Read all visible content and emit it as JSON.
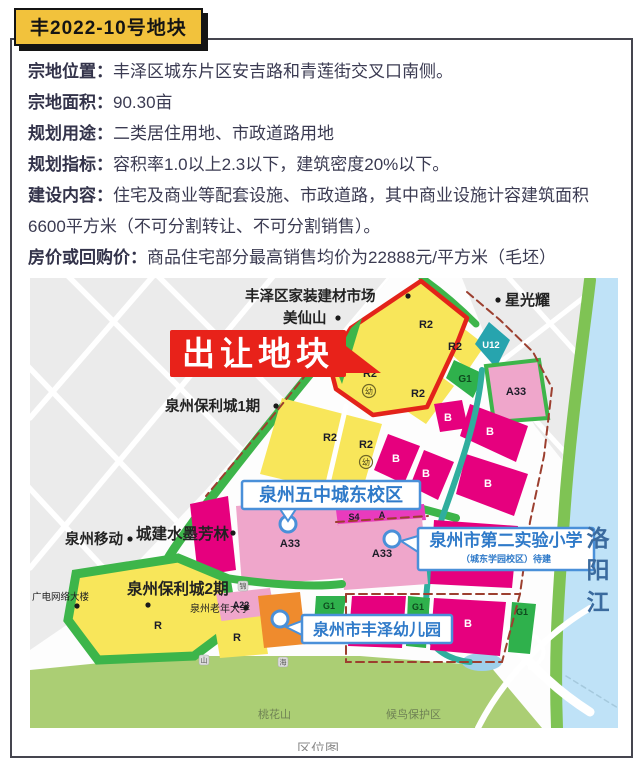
{
  "page": {
    "badge": "丰2022-10号地块",
    "caption": "区位图"
  },
  "info_rows": [
    {
      "label": "宗地位置：",
      "value": "丰泽区城东片区安吉路和青莲街交叉口南侧。"
    },
    {
      "label": "宗地面积：",
      "value": "90.30亩"
    },
    {
      "label": "规划用途：",
      "value": "二类居住用地、市政道路用地"
    },
    {
      "label": "规划指标：",
      "value": "容积率1.0以上2.3以下，建筑密度20%以下。"
    },
    {
      "label": "建设内容：",
      "value": "住宅及商业等配套设施、市政道路，其中商业设施计容建筑面积6600平方米（不可分割转让、不可分割销售）。"
    },
    {
      "label": "房价或回购价：",
      "value": "商品住宅部分最高销售均价为22888元/平方米（毛坯）"
    }
  ],
  "colors": {
    "badge_yellow": "#f2c23c",
    "accent_red": "#e8221a",
    "outline_red": "#e3231a",
    "parcel_yellow": "#f8e65a",
    "parcel_green": "#3db54a",
    "parcel_magenta": "#e6007e",
    "parcel_pink": "#efa6cb",
    "parcel_teal": "#27a4ae",
    "parcel_orange": "#ef8b2d",
    "water_blue": "#bfe2f7",
    "banner_blue": "#4a90d9",
    "boundary_dash": "#9c3f2f"
  },
  "map": {
    "sale_callout": {
      "text": "出让地块",
      "x": 140,
      "y": 52,
      "w": 176,
      "h": 47,
      "arrow": "316,68 351,95 316,95",
      "fill": "#e8221a"
    },
    "river": {
      "chars": [
        "洛",
        "阳",
        "江"
      ],
      "x": 568,
      "y0": 268,
      "dy": 32,
      "fill": "#3a6a9e",
      "fs": 23
    },
    "shapes": [
      {
        "n": "map-background",
        "t": "rect",
        "x": 0,
        "y": 0,
        "wd": 588,
        "ht": 450,
        "f": "#fdfdfd"
      },
      {
        "n": "city-blocks-topleft",
        "t": "polygon",
        "pts": "0,0 360,0 316,52 246,132 174,214 98,294 38,346 0,372",
        "f": "#ebebeb"
      },
      {
        "n": "road",
        "t": "path",
        "d": "M0,140 L130,-10",
        "s": "#ffffff",
        "sw": 5.5,
        "clip": "url(#clipTL)"
      },
      {
        "n": "road",
        "t": "path",
        "d": "M0,290 L250,-10",
        "s": "#ffffff",
        "sw": 5.5,
        "clip": "url(#clipTL)"
      },
      {
        "n": "road",
        "t": "path",
        "d": "M40,380 L360,0",
        "s": "#ffffff",
        "sw": 5.5,
        "clip": "url(#clipTL)"
      },
      {
        "n": "road",
        "t": "path",
        "d": "M150,390 L380,120",
        "s": "#ffffff",
        "sw": 5.5,
        "clip": "url(#clipTL)"
      },
      {
        "n": "road",
        "t": "path",
        "d": "M30,-10 L330,290",
        "s": "#ffffff",
        "sw": 5.5,
        "clip": "url(#clipTL)"
      },
      {
        "n": "road",
        "t": "path",
        "d": "M-10,80 L230,330",
        "s": "#ffffff",
        "sw": 5.5,
        "clip": "url(#clipTL)"
      },
      {
        "n": "road",
        "t": "path",
        "d": "M-10,200 L120,340",
        "s": "#ffffff",
        "sw": 5.5,
        "clip": "url(#clipTL)"
      },
      {
        "n": "road",
        "t": "path",
        "d": "M120,-10 L300,170",
        "s": "#ffffff",
        "sw": 5.5,
        "clip": "url(#clipTL)"
      },
      {
        "n": "city-blocks-topright",
        "t": "polygon",
        "pts": "432,0 566,0 552,98 532,182 505,148 456,60",
        "f": "#ebebeb"
      },
      {
        "n": "road",
        "t": "path",
        "d": "M470,-10 L560,90",
        "s": "#ffffff",
        "sw": 5,
        "clip": "url(#clipTR)"
      },
      {
        "n": "road",
        "t": "path",
        "d": "M430,60 L540,180",
        "s": "#ffffff",
        "sw": 5,
        "clip": "url(#clipTR)"
      },
      {
        "n": "road",
        "t": "path",
        "d": "M450,100 L566,10",
        "s": "#ffffff",
        "sw": 5,
        "clip": "url(#clipTR)"
      },
      {
        "n": "river-water",
        "t": "polygon",
        "pts": "566,0 588,0 588,450 526,450 521,392 526,310 533,236 543,150 556,70",
        "f": "#bfe2f7"
      },
      {
        "n": "shore-green",
        "t": "path",
        "d": "M560,2 C552,70 540,150 534,240 C529,310 524,370 527,450",
        "s": "#7fc354",
        "sw": 12
      },
      {
        "n": "water-boundary-dash",
        "t": "path",
        "d": "M536,398 L588,430",
        "s": "#a5c9dd",
        "sw": 1.5,
        "dash": "5 4"
      },
      {
        "n": "hill-green",
        "t": "polygon",
        "pts": "0,392 140,378 330,378 460,388 512,450 0,450",
        "f": "#abce74"
      },
      {
        "n": "highway",
        "t": "path",
        "d": "M428,268 C452,330 494,392 560,434",
        "s": "#ffffff",
        "sw": 9
      },
      {
        "n": "highway-ramp",
        "t": "path",
        "d": "M560,330 C516,356 472,402 448,450",
        "s": "#ffffff",
        "sw": 6
      },
      {
        "n": "highway-loop",
        "t": "path",
        "d": "M478,362 q20,-16 32,2 q10,16 -10,26",
        "s": "#ffffff",
        "sw": 4
      },
      {
        "n": "pond",
        "t": "ellipse",
        "cx": 452,
        "cy": 384,
        "rx": 20,
        "ry": 9,
        "f": "#9fd0ea"
      },
      {
        "n": "green-strip-west",
        "t": "path",
        "d": "M306,64 C262,118 214,176 166,240 C150,262 138,278 132,292",
        "s": "#3db54a",
        "sw": 9
      },
      {
        "n": "green-strip-north",
        "t": "path",
        "d": "M392,0 C412,14 430,30 446,46",
        "s": "#3db54a",
        "sw": 7
      },
      {
        "n": "parcel-r2-ne",
        "t": "polygon",
        "pts": "428,46 455,67 438,92 408,63",
        "f": "#f8e65a"
      },
      {
        "n": "parcel-u12",
        "t": "polygon",
        "pts": "459,44 480,62 466,90 445,66",
        "f": "#27a4ae"
      },
      {
        "n": "parcel-g1-park",
        "t": "polygon",
        "pts": "424,82 454,96 443,120 416,100",
        "f": "#2fb14c"
      },
      {
        "n": "parcel-a33-ne",
        "t": "polygon",
        "pts": "456,88 509,82 518,140 464,144",
        "f": "#efa6cb",
        "s": "#3db54a",
        "sw": 4
      },
      {
        "n": "parcel-r2-mid",
        "t": "polygon",
        "pts": "394,86 424,108 396,146 360,122",
        "f": "#f8e65a"
      },
      {
        "n": "parcel-b",
        "t": "polygon",
        "pts": "404,126 432,122 438,150 410,154",
        "f": "#e6007e"
      },
      {
        "n": "parcel-b",
        "t": "polygon",
        "pts": "440,126 498,148 486,184 430,158",
        "f": "#e6007e"
      },
      {
        "n": "parcel-r2-southwest",
        "t": "polygon",
        "pts": "252,120 352,146 330,220 230,196",
        "f": "#f8e65a"
      },
      {
        "n": "road",
        "t": "path",
        "d": "M316,128 L296,214",
        "s": "#ffffff",
        "sw": 5
      },
      {
        "n": "parcel-b",
        "t": "polygon",
        "pts": "358,156 390,168 374,206 344,192",
        "f": "#e6007e"
      },
      {
        "n": "parcel-b",
        "t": "polygon",
        "pts": "394,172 424,184 408,222 380,208",
        "f": "#e6007e"
      },
      {
        "n": "parcel-b",
        "t": "polygon",
        "pts": "436,176 498,196 484,238 426,216",
        "f": "#e6007e"
      },
      {
        "n": "green-strip-mid",
        "t": "path",
        "d": "M330,214 L426,240",
        "s": "#3db54a",
        "sw": 8
      },
      {
        "n": "canal",
        "t": "path",
        "d": "M452,92 C448,140 430,190 412,240 C400,280 392,320 398,355 C402,372 420,382 440,384",
        "s": "#2fae9e",
        "sw": 6
      },
      {
        "n": "parcel-shuimo",
        "t": "polygon",
        "pts": "160,226 198,218 206,292 168,298",
        "f": "#e6007e"
      },
      {
        "n": "parcel-a33-school1",
        "t": "polygon",
        "pts": "206,228 306,220 314,300 212,308",
        "f": "#efa6cb"
      },
      {
        "n": "green-edge",
        "t": "path",
        "d": "M309,222 L317,300",
        "s": "#3db54a",
        "sw": 6
      },
      {
        "n": "parcel-s4a-strip",
        "t": "polygon",
        "pts": "306,232 394,226 396,242 308,248",
        "f": "#e93bbd"
      },
      {
        "n": "parcel-a33-school2",
        "t": "polygon",
        "pts": "308,246 392,240 398,306 314,312",
        "f": "#efa6cb"
      },
      {
        "n": "parcel-b",
        "t": "polygon",
        "pts": "404,242 488,248 482,310 400,306",
        "f": "#e6007e"
      },
      {
        "n": "green-strip-south",
        "t": "path",
        "d": "M150,292 C220,306 280,310 312,306",
        "s": "#3db54a",
        "sw": 8
      },
      {
        "n": "parcel-r-poly2",
        "t": "polygon",
        "pts": "46,296 148,280 196,300 204,348 164,378 68,382 38,342",
        "f": "#f8e65a",
        "s": "#3db54a",
        "sw": 9
      },
      {
        "n": "parcel-a22",
        "t": "polygon",
        "pts": "186,316 240,310 246,340 192,346",
        "f": "#efa6cb"
      },
      {
        "n": "parcel-r-small",
        "t": "polygon",
        "pts": "184,344 232,338 238,376 190,380",
        "f": "#f8e65a"
      },
      {
        "n": "parcel-g1-west",
        "t": "polygon",
        "pts": "286,318 316,318 312,348 284,346",
        "f": "#2fb14c"
      },
      {
        "n": "parcel-kindergarten-orange",
        "t": "polygon",
        "pts": "228,318 270,314 276,366 234,370",
        "f": "#ef8b2d"
      },
      {
        "n": "parcel-b",
        "t": "polygon",
        "pts": "322,318 376,318 372,370 318,368",
        "f": "#e6007e"
      },
      {
        "n": "parcel-g1-strip",
        "t": "polygon",
        "pts": "378,318 400,320 396,370 376,368",
        "f": "#2fb14c"
      },
      {
        "n": "parcel-b",
        "t": "polygon",
        "pts": "404,320 476,324 470,378 400,372",
        "f": "#e6007e"
      },
      {
        "n": "parcel-g1-east",
        "t": "polygon",
        "pts": "482,324 506,326 500,376 478,374",
        "f": "#2fb14c"
      },
      {
        "n": "sale-parcel-red-outline",
        "t": "polygon",
        "pts": "391,3 437,40 428,63 397,129 343,137 306,111 299,84 321,50",
        "f": "#f8e65a",
        "s": "#e3231a",
        "sw": 4.5,
        "join": "round"
      },
      {
        "n": "green-sliver",
        "t": "polygon",
        "pts": "321,50 332,40 312,106 303,84",
        "f": "#3db54a"
      },
      {
        "n": "boundary-dash",
        "t": "path",
        "d": "M437,14 L470,42 L503,74 L522,110 L514,178 L500,244 L490,316 L472,384",
        "s": "#9c3f2f",
        "sw": 2,
        "dash": "8 5"
      },
      {
        "n": "boundary-dash",
        "t": "path",
        "d": "M316,316 L490,316",
        "s": "#9c3f2f",
        "sw": 2,
        "dash": "8 5"
      },
      {
        "n": "boundary-dash",
        "t": "path",
        "d": "M316,316 L316,384 L472,384",
        "s": "#9c3f2f",
        "sw": 2,
        "dash": "8 5"
      },
      {
        "n": "boundary-dash",
        "t": "path",
        "d": "M306,244 L398,238",
        "s": "#9c3f2f",
        "sw": 2,
        "dash": "8 5"
      },
      {
        "n": "boundary-dash",
        "t": "path",
        "d": "M302,64 L238,144 L176,218",
        "s": "#9c3f2f",
        "sw": 2,
        "dash": "8 5"
      }
    ],
    "parcel_labels": [
      {
        "txt": "R2",
        "x": 396,
        "y": 50,
        "fs": 11,
        "fill": "#1c1c28",
        "w": "bold"
      },
      {
        "txt": "R2",
        "x": 340,
        "y": 99,
        "fs": 11,
        "fill": "#1c1c28",
        "w": "bold"
      },
      {
        "txt": "R2",
        "x": 425,
        "y": 72,
        "fs": 11,
        "fill": "#1c1c28",
        "w": "bold"
      },
      {
        "txt": "U12",
        "x": 461,
        "y": 70,
        "fs": 9.5,
        "fill": "#ffffff",
        "w": "bold"
      },
      {
        "txt": "G1",
        "x": 435,
        "y": 104,
        "fs": 10,
        "fill": "#0e4a1e",
        "w": "bold"
      },
      {
        "txt": "A33",
        "x": 486,
        "y": 117,
        "fs": 11,
        "fill": "#1c1c28",
        "w": "bold"
      },
      {
        "txt": "R2",
        "x": 388,
        "y": 119,
        "fs": 11,
        "fill": "#1c1c28",
        "w": "bold"
      },
      {
        "txt": "B",
        "x": 418,
        "y": 143,
        "fs": 11,
        "fill": "#ffffff",
        "w": "bold"
      },
      {
        "txt": "B",
        "x": 460,
        "y": 157,
        "fs": 11,
        "fill": "#ffffff",
        "w": "bold"
      },
      {
        "txt": "R2",
        "x": 300,
        "y": 163,
        "fs": 11,
        "fill": "#1c1c28",
        "w": "bold"
      },
      {
        "txt": "R2",
        "x": 336,
        "y": 170,
        "fs": 11,
        "fill": "#1c1c28",
        "w": "bold"
      },
      {
        "txt": "B",
        "x": 366,
        "y": 184,
        "fs": 11,
        "fill": "#ffffff",
        "w": "bold"
      },
      {
        "txt": "B",
        "x": 396,
        "y": 199,
        "fs": 11,
        "fill": "#ffffff",
        "w": "bold"
      },
      {
        "txt": "B",
        "x": 458,
        "y": 209,
        "fs": 11,
        "fill": "#ffffff",
        "w": "bold"
      },
      {
        "txt": "S4",
        "x": 324,
        "y": 242,
        "fs": 9,
        "fill": "#1c1c28",
        "w": "bold"
      },
      {
        "txt": "A",
        "x": 352,
        "y": 240,
        "fs": 9,
        "fill": "#1c1c28",
        "w": "bold"
      },
      {
        "txt": "A33",
        "x": 260,
        "y": 269,
        "fs": 11,
        "fill": "#1c1c28",
        "w": "bold"
      },
      {
        "txt": "A33",
        "x": 352,
        "y": 279,
        "fs": 11,
        "fill": "#1c1c28",
        "w": "bold"
      },
      {
        "txt": "A22",
        "x": 211,
        "y": 330,
        "fs": 9,
        "fill": "#1c1c28",
        "w": "bold"
      },
      {
        "txt": "R",
        "x": 128,
        "y": 351,
        "fs": 11,
        "fill": "#1c1c28",
        "w": "bold"
      },
      {
        "txt": "R",
        "x": 207,
        "y": 363,
        "fs": 11,
        "fill": "#1c1c28",
        "w": "bold"
      },
      {
        "txt": "G1",
        "x": 299,
        "y": 331,
        "fs": 9,
        "fill": "#0e4a1e",
        "w": "bold"
      },
      {
        "txt": "S4",
        "x": 297,
        "y": 343,
        "fs": 8.5,
        "fill": "#0e4a1e",
        "w": "bold"
      },
      {
        "txt": "G1",
        "x": 388,
        "y": 332,
        "fs": 9,
        "fill": "#0e4a1e",
        "w": "bold"
      },
      {
        "txt": "B",
        "x": 438,
        "y": 349,
        "fs": 11,
        "fill": "#ffffff",
        "w": "bold"
      },
      {
        "txt": "G1",
        "x": 492,
        "y": 337,
        "fs": 9,
        "fill": "#0e4a1e",
        "w": "bold"
      }
    ],
    "poi_labels": [
      {
        "txt": "丰泽区家装建材市场",
        "x": 215,
        "y": 23,
        "fs": 14.5,
        "w": "600"
      },
      {
        "txt": "美仙山",
        "x": 253,
        "y": 45,
        "fs": 14.5,
        "w": "600"
      },
      {
        "txt": "星光耀",
        "x": 475,
        "y": 27,
        "fs": 15,
        "w": "600"
      },
      {
        "txt": "泉州保利城1期",
        "x": 135,
        "y": 133,
        "fs": 14.5,
        "w": "600"
      },
      {
        "txt": "泉州移动",
        "x": 35,
        "y": 266,
        "fs": 14.5,
        "w": "600"
      },
      {
        "txt": "城建水墨芳林",
        "x": 106,
        "y": 261,
        "fs": 15.5,
        "w": "bold"
      },
      {
        "txt": "广电网络大楼",
        "x": 2,
        "y": 322,
        "fs": 9.5,
        "w": "normal"
      },
      {
        "txt": "泉州保利城2期",
        "x": 97,
        "y": 316,
        "fs": 15.5,
        "w": "bold"
      },
      {
        "txt": "泉州老年大学",
        "x": 160,
        "y": 334,
        "fs": 10,
        "w": "normal"
      },
      {
        "txt": "桃花山",
        "x": 228,
        "y": 440,
        "fs": 11,
        "w": "normal",
        "fill": "#6f8254"
      },
      {
        "txt": "候鸟保护区",
        "x": 356,
        "y": 440,
        "fs": 11,
        "w": "normal",
        "fill": "#6f8254"
      }
    ],
    "dots": [
      {
        "x": 378,
        "y": 18
      },
      {
        "x": 308,
        "y": 40
      },
      {
        "x": 468,
        "y": 22
      },
      {
        "x": 246,
        "y": 128
      },
      {
        "x": 100,
        "y": 261
      },
      {
        "x": 203,
        "y": 255
      },
      {
        "x": 47,
        "y": 328
      },
      {
        "x": 118,
        "y": 327
      },
      {
        "x": 216,
        "y": 330
      }
    ],
    "road_badges": [
      {
        "c": "锦",
        "x": 213,
        "y": 308
      },
      {
        "c": "海",
        "x": 240,
        "y": 218
      },
      {
        "c": "山",
        "x": 174,
        "y": 382
      },
      {
        "c": "海",
        "x": 253,
        "y": 384
      }
    ],
    "banners": [
      {
        "text": "泉州五中城东校区",
        "x": 212,
        "y": 203,
        "w": 178,
        "h": 28,
        "fs": 18,
        "tail": "250,231 266,231 258,243",
        "cx": 258,
        "cy": 246
      },
      {
        "text": "泉州市第二实验小学",
        "sub": "（城东学园校区）待建",
        "x": 388,
        "y": 250,
        "w": 176,
        "h": 42,
        "fs": 17,
        "tail": "388,258 388,274 371,263",
        "cx": 362,
        "cy": 261
      },
      {
        "text": "泉州市丰泽幼儿园",
        "x": 272,
        "y": 337,
        "w": 150,
        "h": 28,
        "fs": 16,
        "tail": "272,343 272,357 256,349",
        "cx": 250,
        "cy": 341
      }
    ],
    "kindergarten_symbols": [
      {
        "x": 339,
        "y": 113
      },
      {
        "x": 336,
        "y": 184
      }
    ],
    "kindergarten_char": "幼"
  }
}
